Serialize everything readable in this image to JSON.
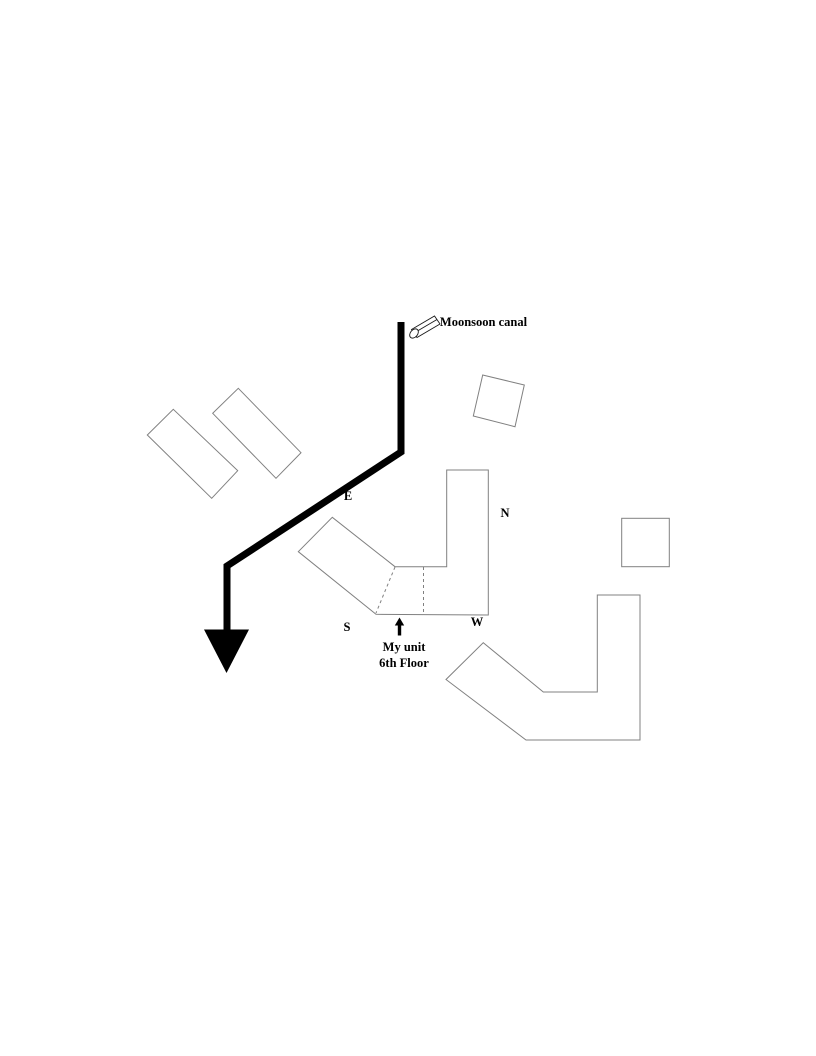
{
  "diagram": {
    "canal_label": "Moonsoon canal",
    "compass": {
      "east": "E",
      "north": "N",
      "south": "S",
      "west": "W"
    },
    "unit_caption": {
      "line1": "My unit",
      "line2": "6th Floor"
    }
  },
  "colors": {
    "background": "#ffffff",
    "building_outline": "#808080",
    "dashed_divider": "#808080",
    "flow_arrow": "#000000",
    "icon_outline": "#1a1a1a",
    "text": "#000000"
  }
}
